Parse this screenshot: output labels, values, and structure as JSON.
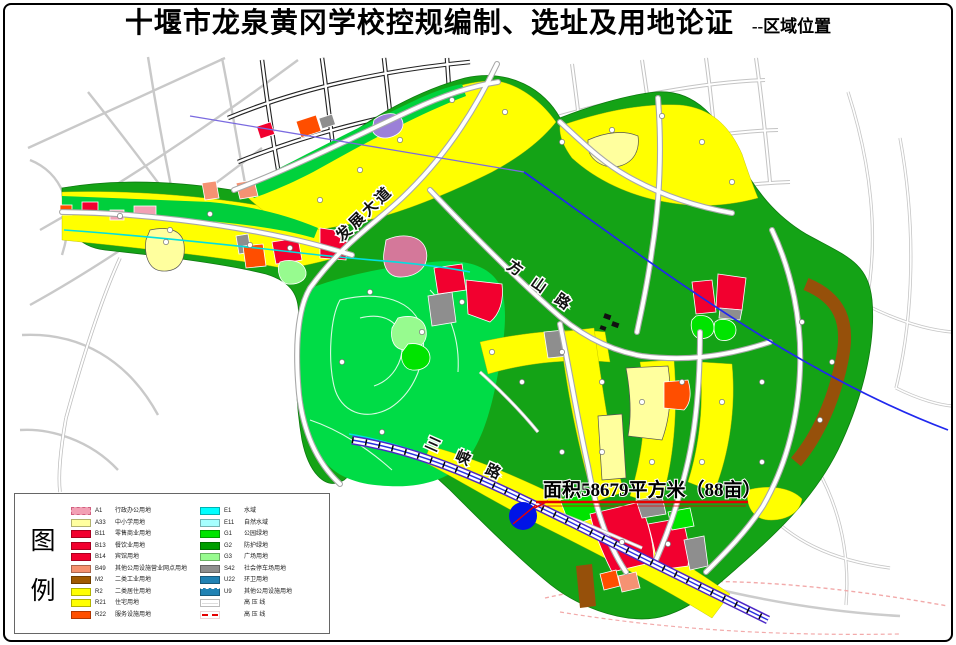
{
  "page": {
    "title": "十堰市龙泉黄冈学校控规编制、选址及用地论证",
    "subtitle": "--区域位置"
  },
  "map": {
    "road_labels": [
      {
        "text": "发展大道"
      },
      {
        "text": "方山路"
      },
      {
        "text": "三峡路"
      }
    ],
    "annotation": {
      "text": "面积58679平方米（88亩）",
      "underline_color": "#E60000"
    },
    "marker": {
      "shape": "circle",
      "color": "#0014E6"
    },
    "power_line_color": "#2028EE"
  },
  "legend": {
    "heading_chars": [
      "图",
      "例"
    ],
    "left_items": [
      {
        "code": "A1",
        "label": "行政办公用地",
        "color": "#F2A0B4"
      },
      {
        "code": "A33",
        "label": "中小学用地",
        "color": "#FFFF9E"
      },
      {
        "code": "B11",
        "label": "零售商业用地",
        "color": "#F2002F"
      },
      {
        "code": "B13",
        "label": "餐饮业用地",
        "color": "#F2002F"
      },
      {
        "code": "B14",
        "label": "宾馆用地",
        "color": "#F2002F"
      },
      {
        "code": "B49",
        "label": "其他公用设施营业网点用地",
        "color": "#F5916E"
      },
      {
        "code": "M2",
        "label": "二类工业用地",
        "color": "#A05A00"
      },
      {
        "code": "R2",
        "label": "二类居住用地",
        "color": "#FFFF00"
      },
      {
        "code": "R21",
        "label": "住宅用地",
        "color": "#FFFF00"
      },
      {
        "code": "R22",
        "label": "服务设施用地",
        "color": "#FF5000"
      }
    ],
    "right_items": [
      {
        "code": "E1",
        "label": "水域",
        "color": "#00FFFF"
      },
      {
        "code": "E11",
        "label": "自然水域",
        "color": "#A5FFFF"
      },
      {
        "code": "G1",
        "label": "公园绿地",
        "color": "#00E400"
      },
      {
        "code": "G2",
        "label": "防护绿地",
        "color": "#009E00"
      },
      {
        "code": "G3",
        "label": "广场用地",
        "color": "#97FB8F"
      },
      {
        "code": "S42",
        "label": "社会停车场用地",
        "color": "#8E8E8E"
      },
      {
        "code": "U22",
        "label": "环卫用地",
        "color": "#2082B4"
      },
      {
        "code": "U9",
        "label": "其他公用设施用地",
        "color": "#2082B4"
      },
      {
        "code": "",
        "label": "高 压 线",
        "color": "#FFFFFF"
      },
      {
        "code": "",
        "label": "高 压 线",
        "color": "#E60000"
      }
    ]
  }
}
